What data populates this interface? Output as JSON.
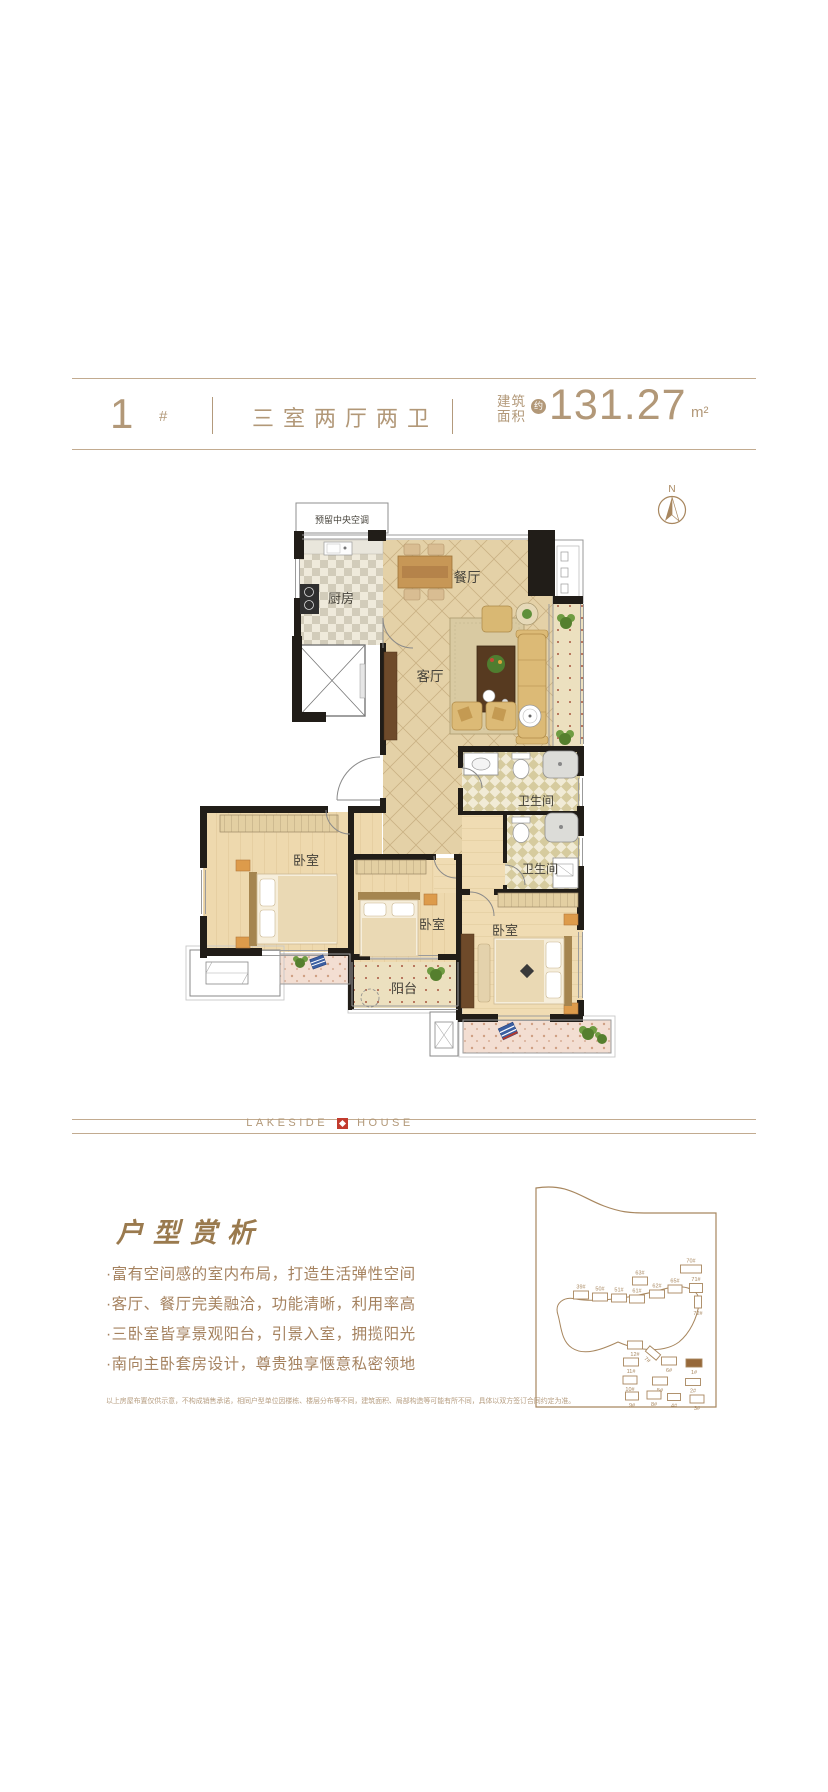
{
  "header": {
    "unit_number": "1",
    "unit_suffix": "#",
    "layout_type": "三室两厅两卫",
    "area_label_top": "建筑",
    "area_label_bottom": "面积",
    "area_approx_badge": "约",
    "area_value": "131.27",
    "area_unit": "m²"
  },
  "floor_plan": {
    "compass": "N",
    "labels": {
      "ac_reserve": "预留中央空调",
      "kitchen": "厨房",
      "dining": "餐厅",
      "living": "客厅",
      "bath_1": "卫生间",
      "bath_2": "卫生间",
      "bedroom_left": "卧室",
      "bedroom_middle": "卧室",
      "bedroom_master": "卧室",
      "balcony": "阳台"
    }
  },
  "brand": {
    "left": "LAKESIDE",
    "right": "HOUSE"
  },
  "analysis": {
    "title": "户型赏析",
    "bullets": [
      "·富有空间感的室内布局，打造生活弹性空间",
      "·客厅、餐厅完美融洽，功能清晰，利用率高",
      "·三卧室皆享景观阳台，引景入室，拥揽阳光",
      "·南向主卧套房设计，尊贵独享惬意私密领地"
    ],
    "disclaimer": "以上房屋布置仅供示意，不构成销售承诺，相同户型单位因楼栋、楼层分布等不同，建筑面积、局部构造等可能有所不同，具体以双方签订合同约定为准。"
  },
  "site_map": {
    "line_color": "#a8875f",
    "highlight_color": "#96683a",
    "buildings": [
      {
        "label": "39#",
        "x": 53,
        "y": 110,
        "w": 15,
        "h": 8,
        "lp": "above"
      },
      {
        "label": "50#",
        "x": 72,
        "y": 112,
        "w": 15,
        "h": 8,
        "lp": "above"
      },
      {
        "label": "51#",
        "x": 91,
        "y": 113,
        "w": 15,
        "h": 8,
        "lp": "above"
      },
      {
        "label": "61#",
        "x": 109,
        "y": 114,
        "w": 15,
        "h": 8,
        "lp": "above"
      },
      {
        "label": "62#",
        "x": 129,
        "y": 109,
        "w": 15,
        "h": 8,
        "lp": "above"
      },
      {
        "label": "63#",
        "x": 112,
        "y": 96,
        "w": 15,
        "h": 8,
        "lp": "above"
      },
      {
        "label": "65#",
        "x": 147,
        "y": 104,
        "w": 14,
        "h": 8,
        "lp": "above"
      },
      {
        "label": "70#",
        "x": 163,
        "y": 84,
        "w": 21,
        "h": 8,
        "lp": "above"
      },
      {
        "label": "71#",
        "x": 168,
        "y": 103,
        "w": 13,
        "h": 9,
        "lp": "above"
      },
      {
        "label": "72#",
        "x": 170,
        "y": 117,
        "w": 7,
        "h": 12,
        "lp": "below"
      },
      {
        "label": "12#",
        "x": 107,
        "y": 160,
        "w": 15,
        "h": 8,
        "lp": "below"
      },
      {
        "label": "7#",
        "x": 125,
        "y": 168,
        "w": 14,
        "h": 7,
        "lp": "below",
        "rot": 40
      },
      {
        "label": "6#",
        "x": 141,
        "y": 176,
        "w": 15,
        "h": 8,
        "lp": "below"
      },
      {
        "label": "1#",
        "x": 166,
        "y": 178,
        "w": 16,
        "h": 8,
        "lp": "below",
        "filled": true
      },
      {
        "label": "11#",
        "x": 103,
        "y": 177,
        "w": 15,
        "h": 8,
        "lp": "below"
      },
      {
        "label": "10#",
        "x": 102,
        "y": 195,
        "w": 14,
        "h": 8,
        "lp": "below"
      },
      {
        "label": "5#",
        "x": 132,
        "y": 196,
        "w": 15,
        "h": 8,
        "lp": "below"
      },
      {
        "label": "2#",
        "x": 165,
        "y": 197,
        "w": 15,
        "h": 7,
        "lp": "below"
      },
      {
        "label": "9#",
        "x": 104,
        "y": 211,
        "w": 13,
        "h": 8,
        "lp": "below"
      },
      {
        "label": "8#",
        "x": 126,
        "y": 210,
        "w": 14,
        "h": 8,
        "lp": "below"
      },
      {
        "label": "4#",
        "x": 146,
        "y": 212,
        "w": 13,
        "h": 7,
        "lp": "below"
      },
      {
        "label": "3#",
        "x": 169,
        "y": 214,
        "w": 14,
        "h": 8,
        "lp": "below"
      }
    ]
  }
}
